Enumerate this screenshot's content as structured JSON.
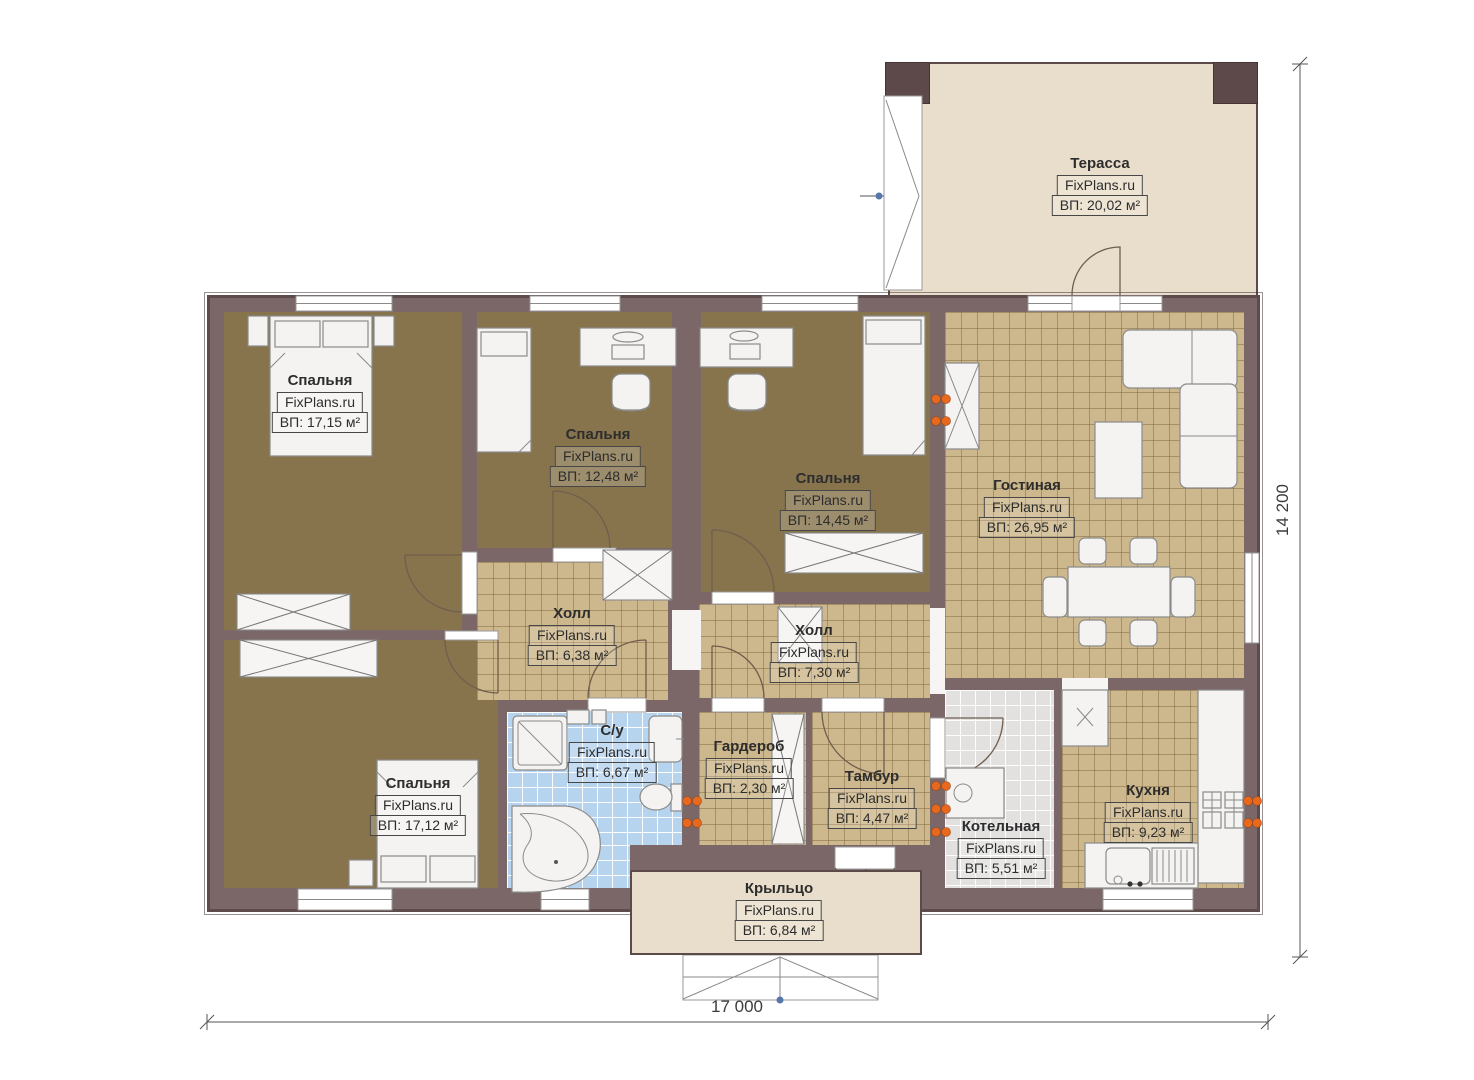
{
  "watermark": "FixPlans.ru",
  "rooms": {
    "terrace": {
      "name": "Терасса",
      "area": "ВП: 20,02 м²"
    },
    "bedroom1": {
      "name": "Спальня",
      "area": "ВП: 17,15 м²"
    },
    "bedroom2": {
      "name": "Спальня",
      "area": "ВП: 12,48 м²"
    },
    "bedroom3": {
      "name": "Спальня",
      "area": "ВП: 14,45 м²"
    },
    "living": {
      "name": "Гостиная",
      "area": "ВП: 26,95 м²"
    },
    "hall1": {
      "name": "Холл",
      "area": "ВП: 6,38 м²"
    },
    "hall2": {
      "name": "Холл",
      "area": "ВП: 7,30 м²"
    },
    "bathroom": {
      "name": "С/у",
      "area": "ВП: 6,67 м²"
    },
    "wardrobe": {
      "name": "Гардероб",
      "area": "ВП: 2,30 м²"
    },
    "tambour": {
      "name": "Тамбур",
      "area": "ВП: 4,47 м²"
    },
    "bedroom4": {
      "name": "Спальня",
      "area": "ВП: 17,12 м²"
    },
    "boiler": {
      "name": "Котельная",
      "area": "ВП: 5,51 м²"
    },
    "kitchen": {
      "name": "Кухня",
      "area": "ВП: 9,23 м²"
    },
    "porch": {
      "name": "Крыльцо",
      "area": "ВП: 6,84 м²"
    }
  },
  "dimensions": {
    "width_label": "17 000",
    "height_label": "14 200"
  },
  "colors": {
    "wall": "#7b6767",
    "bedroom_floor": "#87744d",
    "tile_floor": "#cdb78c",
    "bath_floor": "#b7d4ef",
    "boiler_floor": "#e2e1e0",
    "outdoor": "#e9decb",
    "radiator": "#e8681e"
  }
}
